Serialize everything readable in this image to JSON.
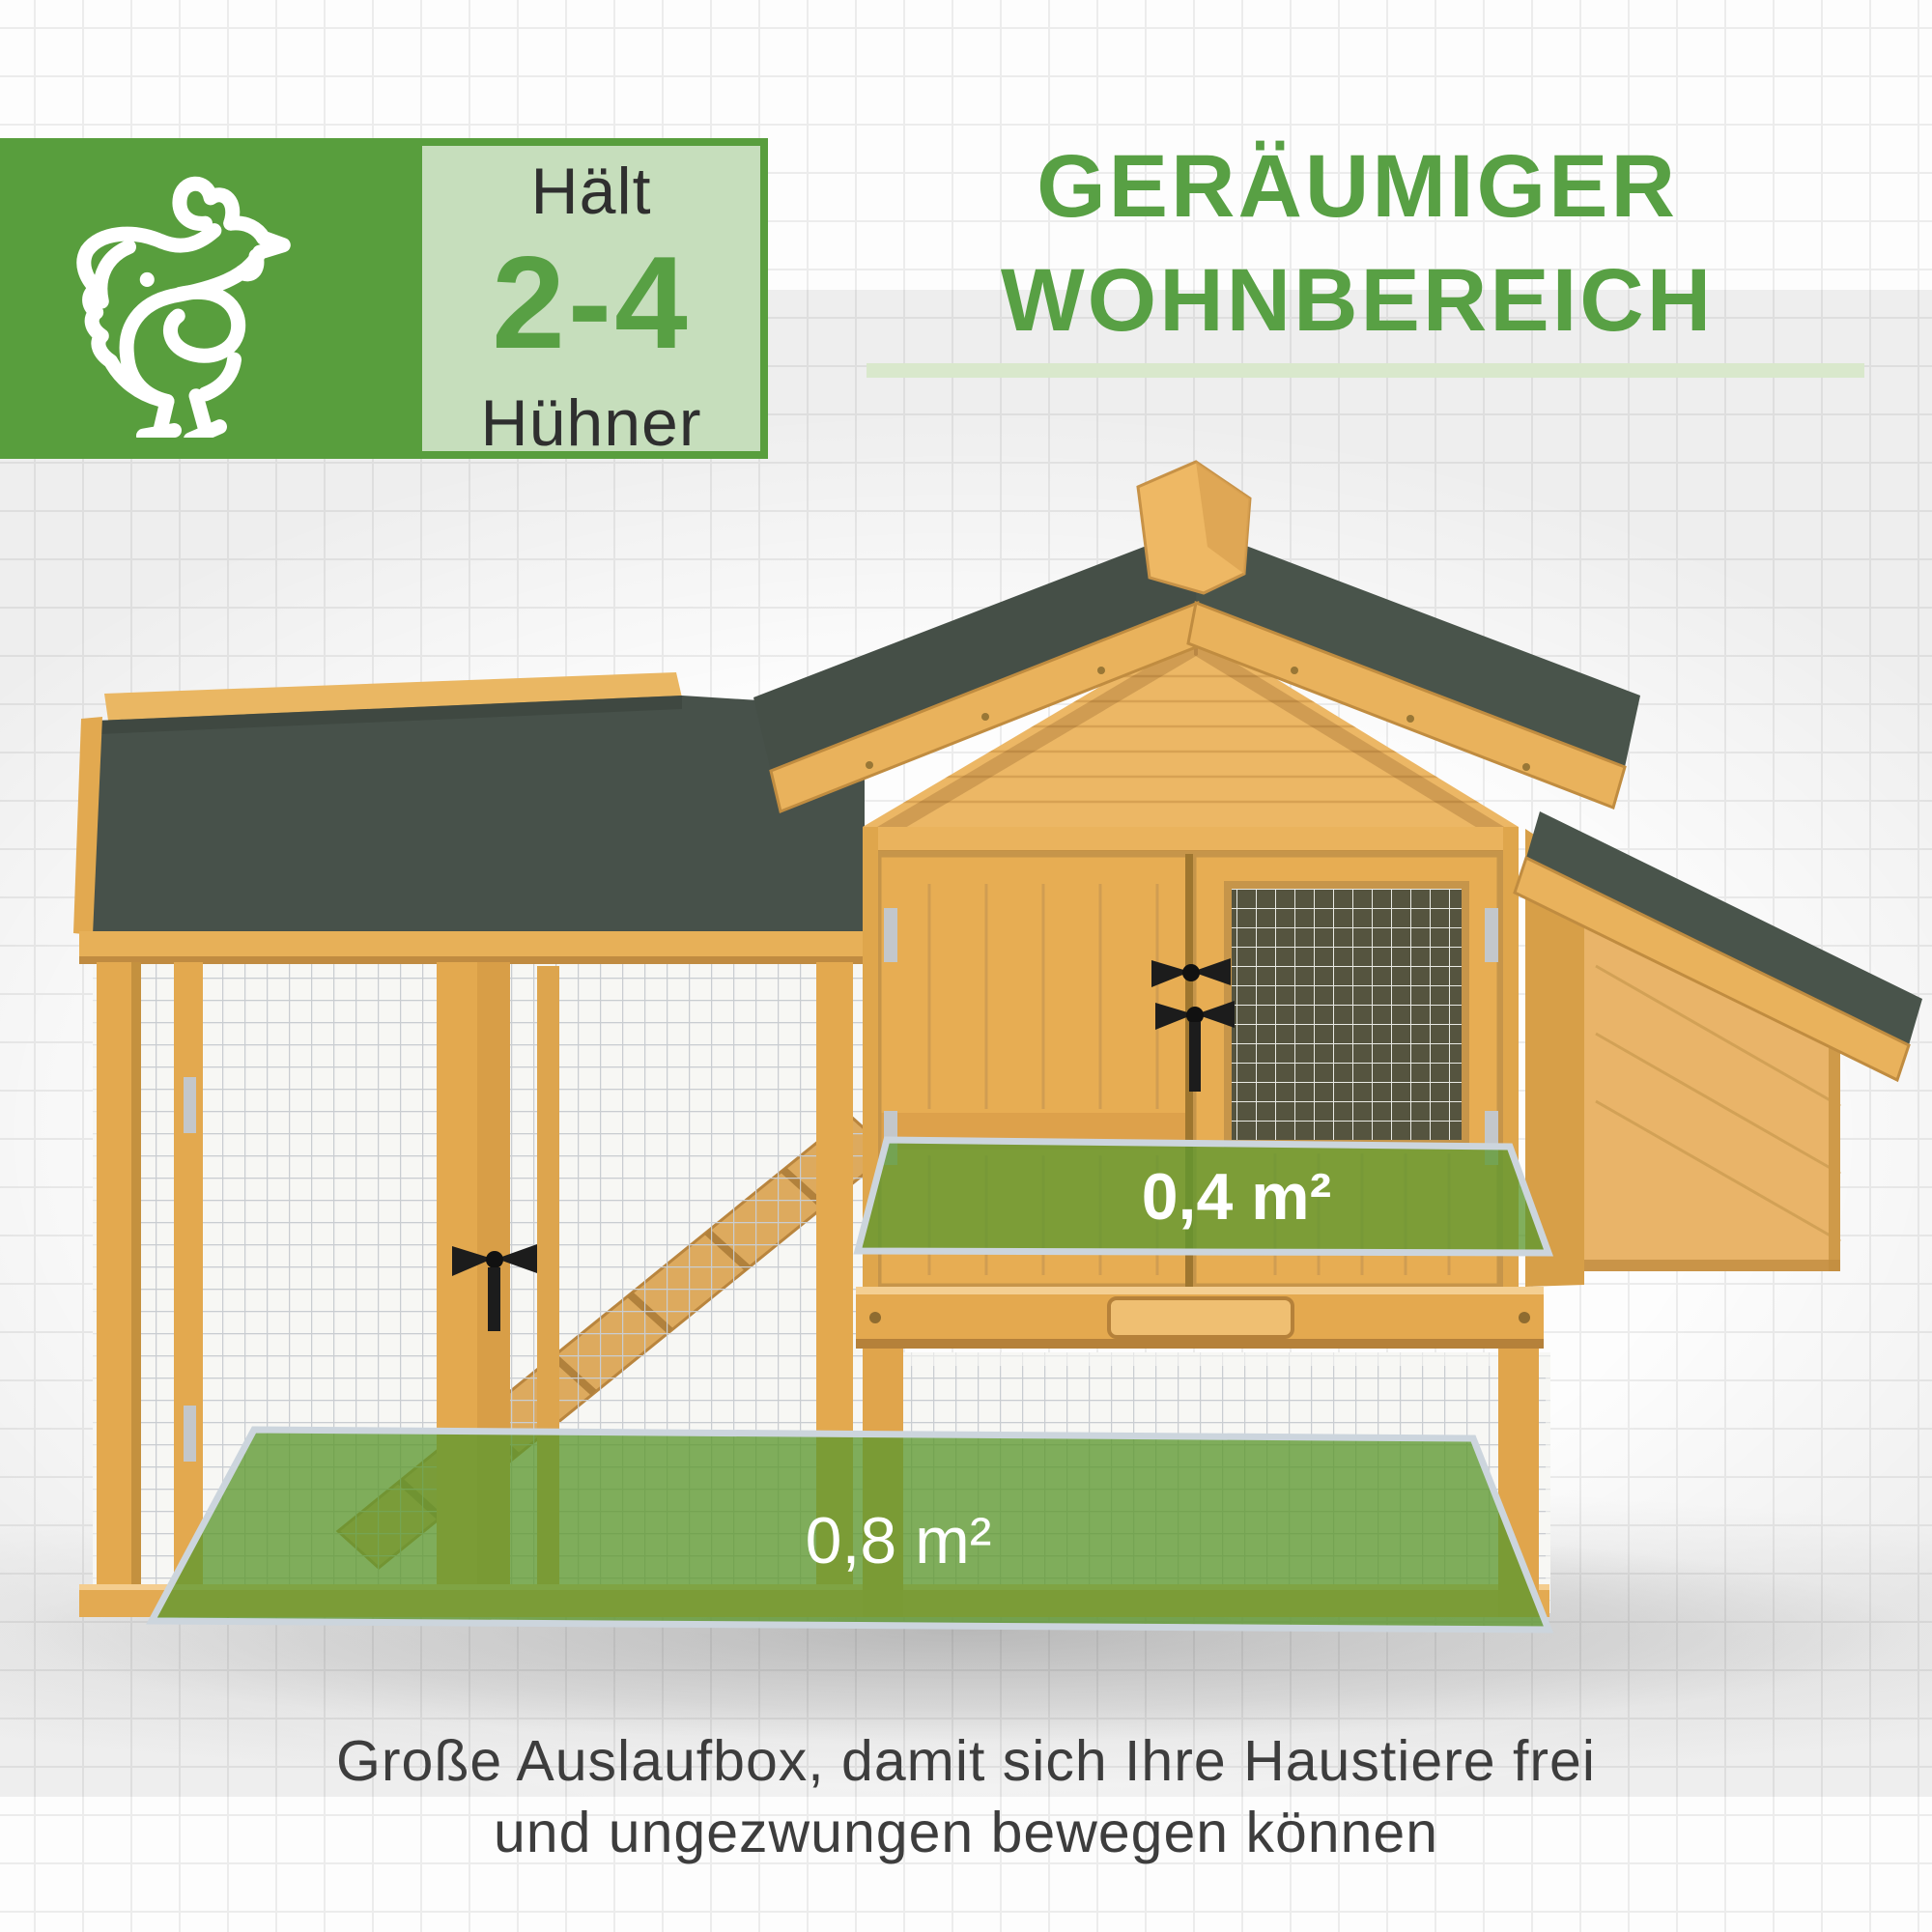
{
  "header": {
    "capacity_box": {
      "icon": "chicken-icon",
      "label_top": "Hält",
      "value": "2-4",
      "label_bottom": "Hühner"
    },
    "title": {
      "line1": "GERÄUMIGER",
      "line2": "WOHNBEREICH"
    }
  },
  "illustration": {
    "upper_area_label": "0,4 m²",
    "lower_area_label": "0,8 m²"
  },
  "caption": {
    "line1": "Große Auslaufbox, damit sich Ihre Haustiere frei",
    "line2": "und ungezwungen bewegen können"
  },
  "colors": {
    "accent_green": "#58a044",
    "box_green": "#589e3d",
    "underline_green": "#d9e8cc",
    "overlay_green": "#5e9830",
    "overlay_border": "#ccd5dd",
    "roof_green": "#47514a",
    "wood": "#e8ae58",
    "text_dark": "#3d3d3d"
  }
}
